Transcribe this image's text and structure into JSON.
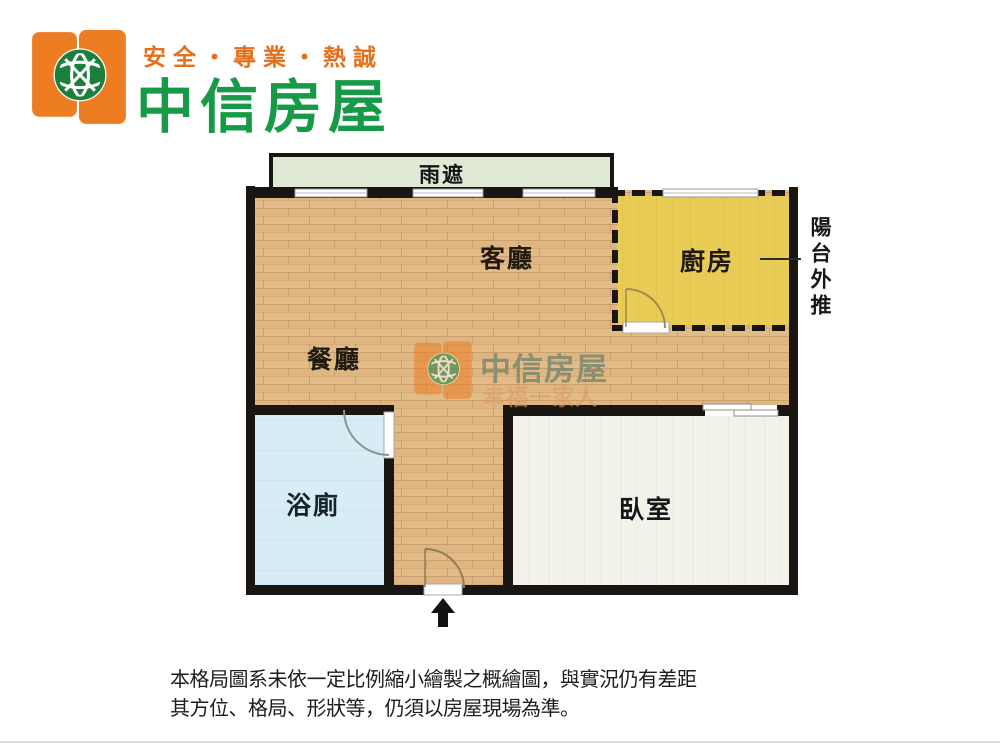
{
  "brand": {
    "slogan": "安全・專業・熱誠",
    "name": "中信房屋"
  },
  "floorplan": {
    "labels": {
      "canopy": "雨遮",
      "living": "客廳",
      "kitchen": "廚房",
      "dining": "餐廳",
      "bathroom": "浴廁",
      "bedroom": "臥室",
      "balcony_note": "陽台外推"
    },
    "colors": {
      "wood": "#e2bb87",
      "kitchen": "#e8cc55",
      "bathroom": "#d7edf5",
      "bedroom": "#f3f2ea",
      "canopy": "#dfe9d5",
      "wall": "#181512"
    }
  },
  "watermark": {
    "name": "中信房屋",
    "tagline": "幸福一家人"
  },
  "disclaimer": {
    "line1": "本格局圖系未依一定比例縮小繪製之概繪圖，與實況仍有差距",
    "line2": "其方位、格局、形狀等，仍須以房屋現場為準。"
  }
}
